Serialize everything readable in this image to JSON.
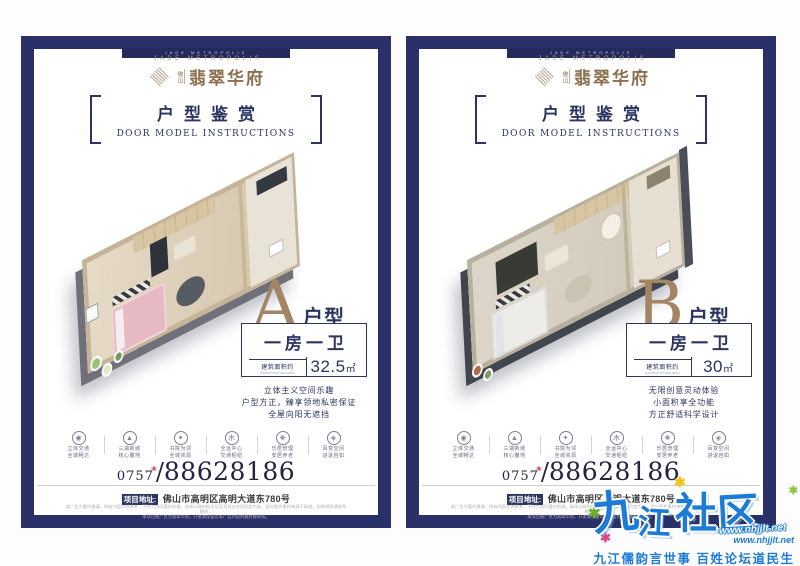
{
  "shared": {
    "notch_text": "JADE METROPOLIS",
    "brand": {
      "en": "JADE METROPOLIS",
      "city": "佛山",
      "cn": "翡翠华府"
    },
    "section": {
      "cn": "户型鉴赏",
      "en": "DOOR MODEL INSTRUCTIONS"
    },
    "area_label": "建筑面积约",
    "area_sublabel": "CONSTRUCTION AREA ABOUT",
    "features": [
      {
        "icon": "◉",
        "line1": "立体交通",
        "line2": "全城畅达"
      },
      {
        "icon": "▲",
        "line1": "三湖新城",
        "line2": "核心腹地"
      },
      {
        "icon": "✦",
        "line1": "书院为邻",
        "line2": "全城资源"
      },
      {
        "icon": "木",
        "line1": "全运中心",
        "line2": "交通枢纽"
      },
      {
        "icon": "❋",
        "line1": "乐居管理",
        "line2": "安居养老"
      },
      {
        "icon": "◈",
        "line1": "百变空间",
        "line2": "进退自如"
      }
    ],
    "phone": {
      "prefix": "0757",
      "flower": "❀",
      "slash": "/",
      "number": "88628186"
    },
    "address": {
      "label": "项目地址:",
      "value": "佛山市高明区高明大道东780号"
    },
    "disclaimer1": "本广告为要约邀请，所有内容仅供参考，不作为合同要约依据，具体以政府批文及买卖双方合同约定为准，部分图片素材来源于网络，如有侵权请联系删除，",
    "disclaimer2": "本项目推广名为翡翠华府，开发商保留对本广告内容的最终解释权。"
  },
  "poster_a": {
    "letter": "A",
    "suffix": "户型",
    "layout": "一房一卫",
    "area": "32.5",
    "unit": "㎡",
    "desc": [
      "立体主义空间乐趣",
      "户型方正，臻享领地私密保证",
      "全屋向阳无遮挡"
    ]
  },
  "poster_b": {
    "letter": "B",
    "suffix": "户型",
    "layout": "一房一卫",
    "area": "30",
    "unit": "㎡",
    "desc": [
      "无限创意灵动体验",
      "小面积享全功能",
      "方正舒适科学设计"
    ]
  },
  "watermark": {
    "chars": [
      "九",
      "江",
      "社",
      "区"
    ],
    "url_outline": "www.nhjjlt.net",
    "url_plain": "www.nhjjlt.net",
    "tagline": "九江儒韵言世事  百姓论坛道民生",
    "star": "✱"
  },
  "colors": {
    "frame_navy": "#2a3169",
    "text_navy": "#2b3560",
    "bronze": "#a28564",
    "watermark_blue": "#1d7bd8"
  }
}
